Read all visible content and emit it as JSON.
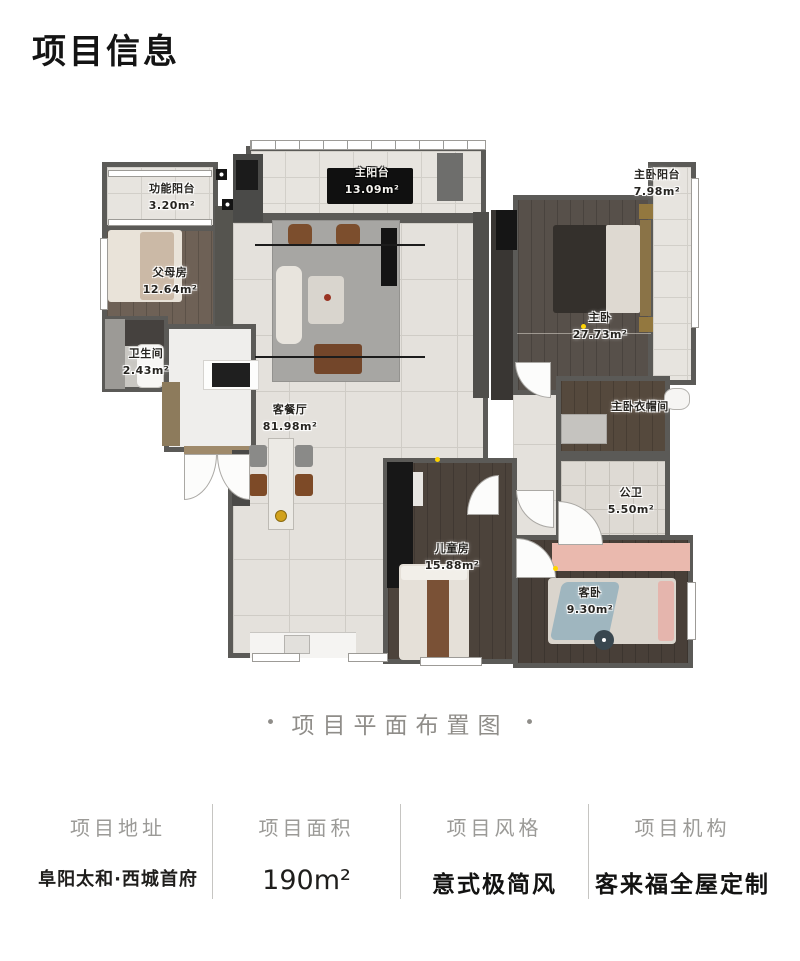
{
  "header": {
    "title": "项目信息"
  },
  "floor_plan": {
    "caption": "项目平面布置图",
    "caption_dot": "•",
    "rooms": [
      {
        "name": "功能阳台",
        "area": "3.20m²"
      },
      {
        "name": "父母房",
        "area": "12.64m²"
      },
      {
        "name": "卫生间",
        "area": "2.43m²"
      },
      {
        "name": "主阳台",
        "area": "13.09m²"
      },
      {
        "name": "客餐厅",
        "area": "81.98m²"
      },
      {
        "name": "主卧",
        "area": "27.73m²"
      },
      {
        "name": "主卧阳台",
        "area": "7.98m²"
      },
      {
        "name": "主卧衣帽间",
        "area": ""
      },
      {
        "name": "公卫",
        "area": "5.50m²"
      },
      {
        "name": "儿童房",
        "area": "15.88m²"
      },
      {
        "name": "客卧",
        "area": "9.30m²"
      }
    ]
  },
  "info": {
    "columns": [
      {
        "label": "项目地址",
        "value": "阜阳太和·西城首府"
      },
      {
        "label": "项目面积",
        "value": "190m²"
      },
      {
        "label": "项目风格",
        "value": "意式极简风"
      },
      {
        "label": "项目机构",
        "value": "客来福全屋定制"
      }
    ]
  }
}
